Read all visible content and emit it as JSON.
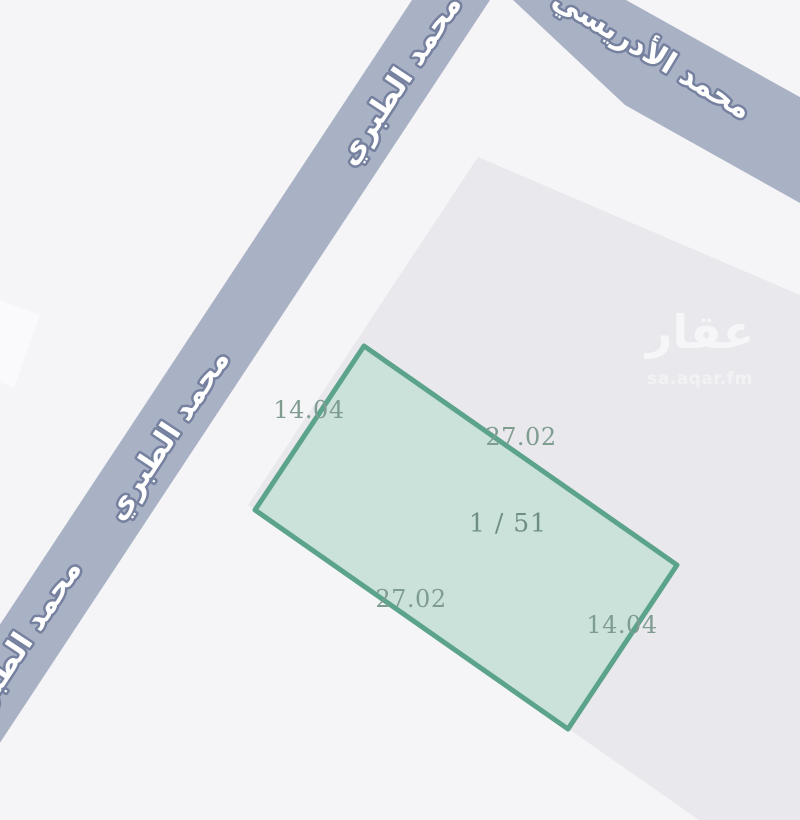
{
  "colors": {
    "background": "#f5f4f6",
    "block": "#e9e8ec",
    "road": "#a9b1c5",
    "road_label_halo": "#76819f",
    "road_label_fill": "#ffffff",
    "building": "#fafafc",
    "parcel_fill": "#b7dece",
    "parcel_border": "#5ca38c",
    "dimension_text": "#7f9c91",
    "parcel_number_text": "#6f8e85",
    "watermark_text": "#ffffff"
  },
  "streets": {
    "tabari": {
      "name": "محمد الطبري"
    },
    "idrisi": {
      "name": "محمد الأدريسي"
    }
  },
  "parcel": {
    "number": "1 / 51",
    "dims": {
      "nw": "14.04",
      "ne": "27.02",
      "sw": "27.02",
      "se": "14.04"
    }
  },
  "watermark": {
    "logo": "عقار",
    "site": "sa.aqar.fm"
  }
}
